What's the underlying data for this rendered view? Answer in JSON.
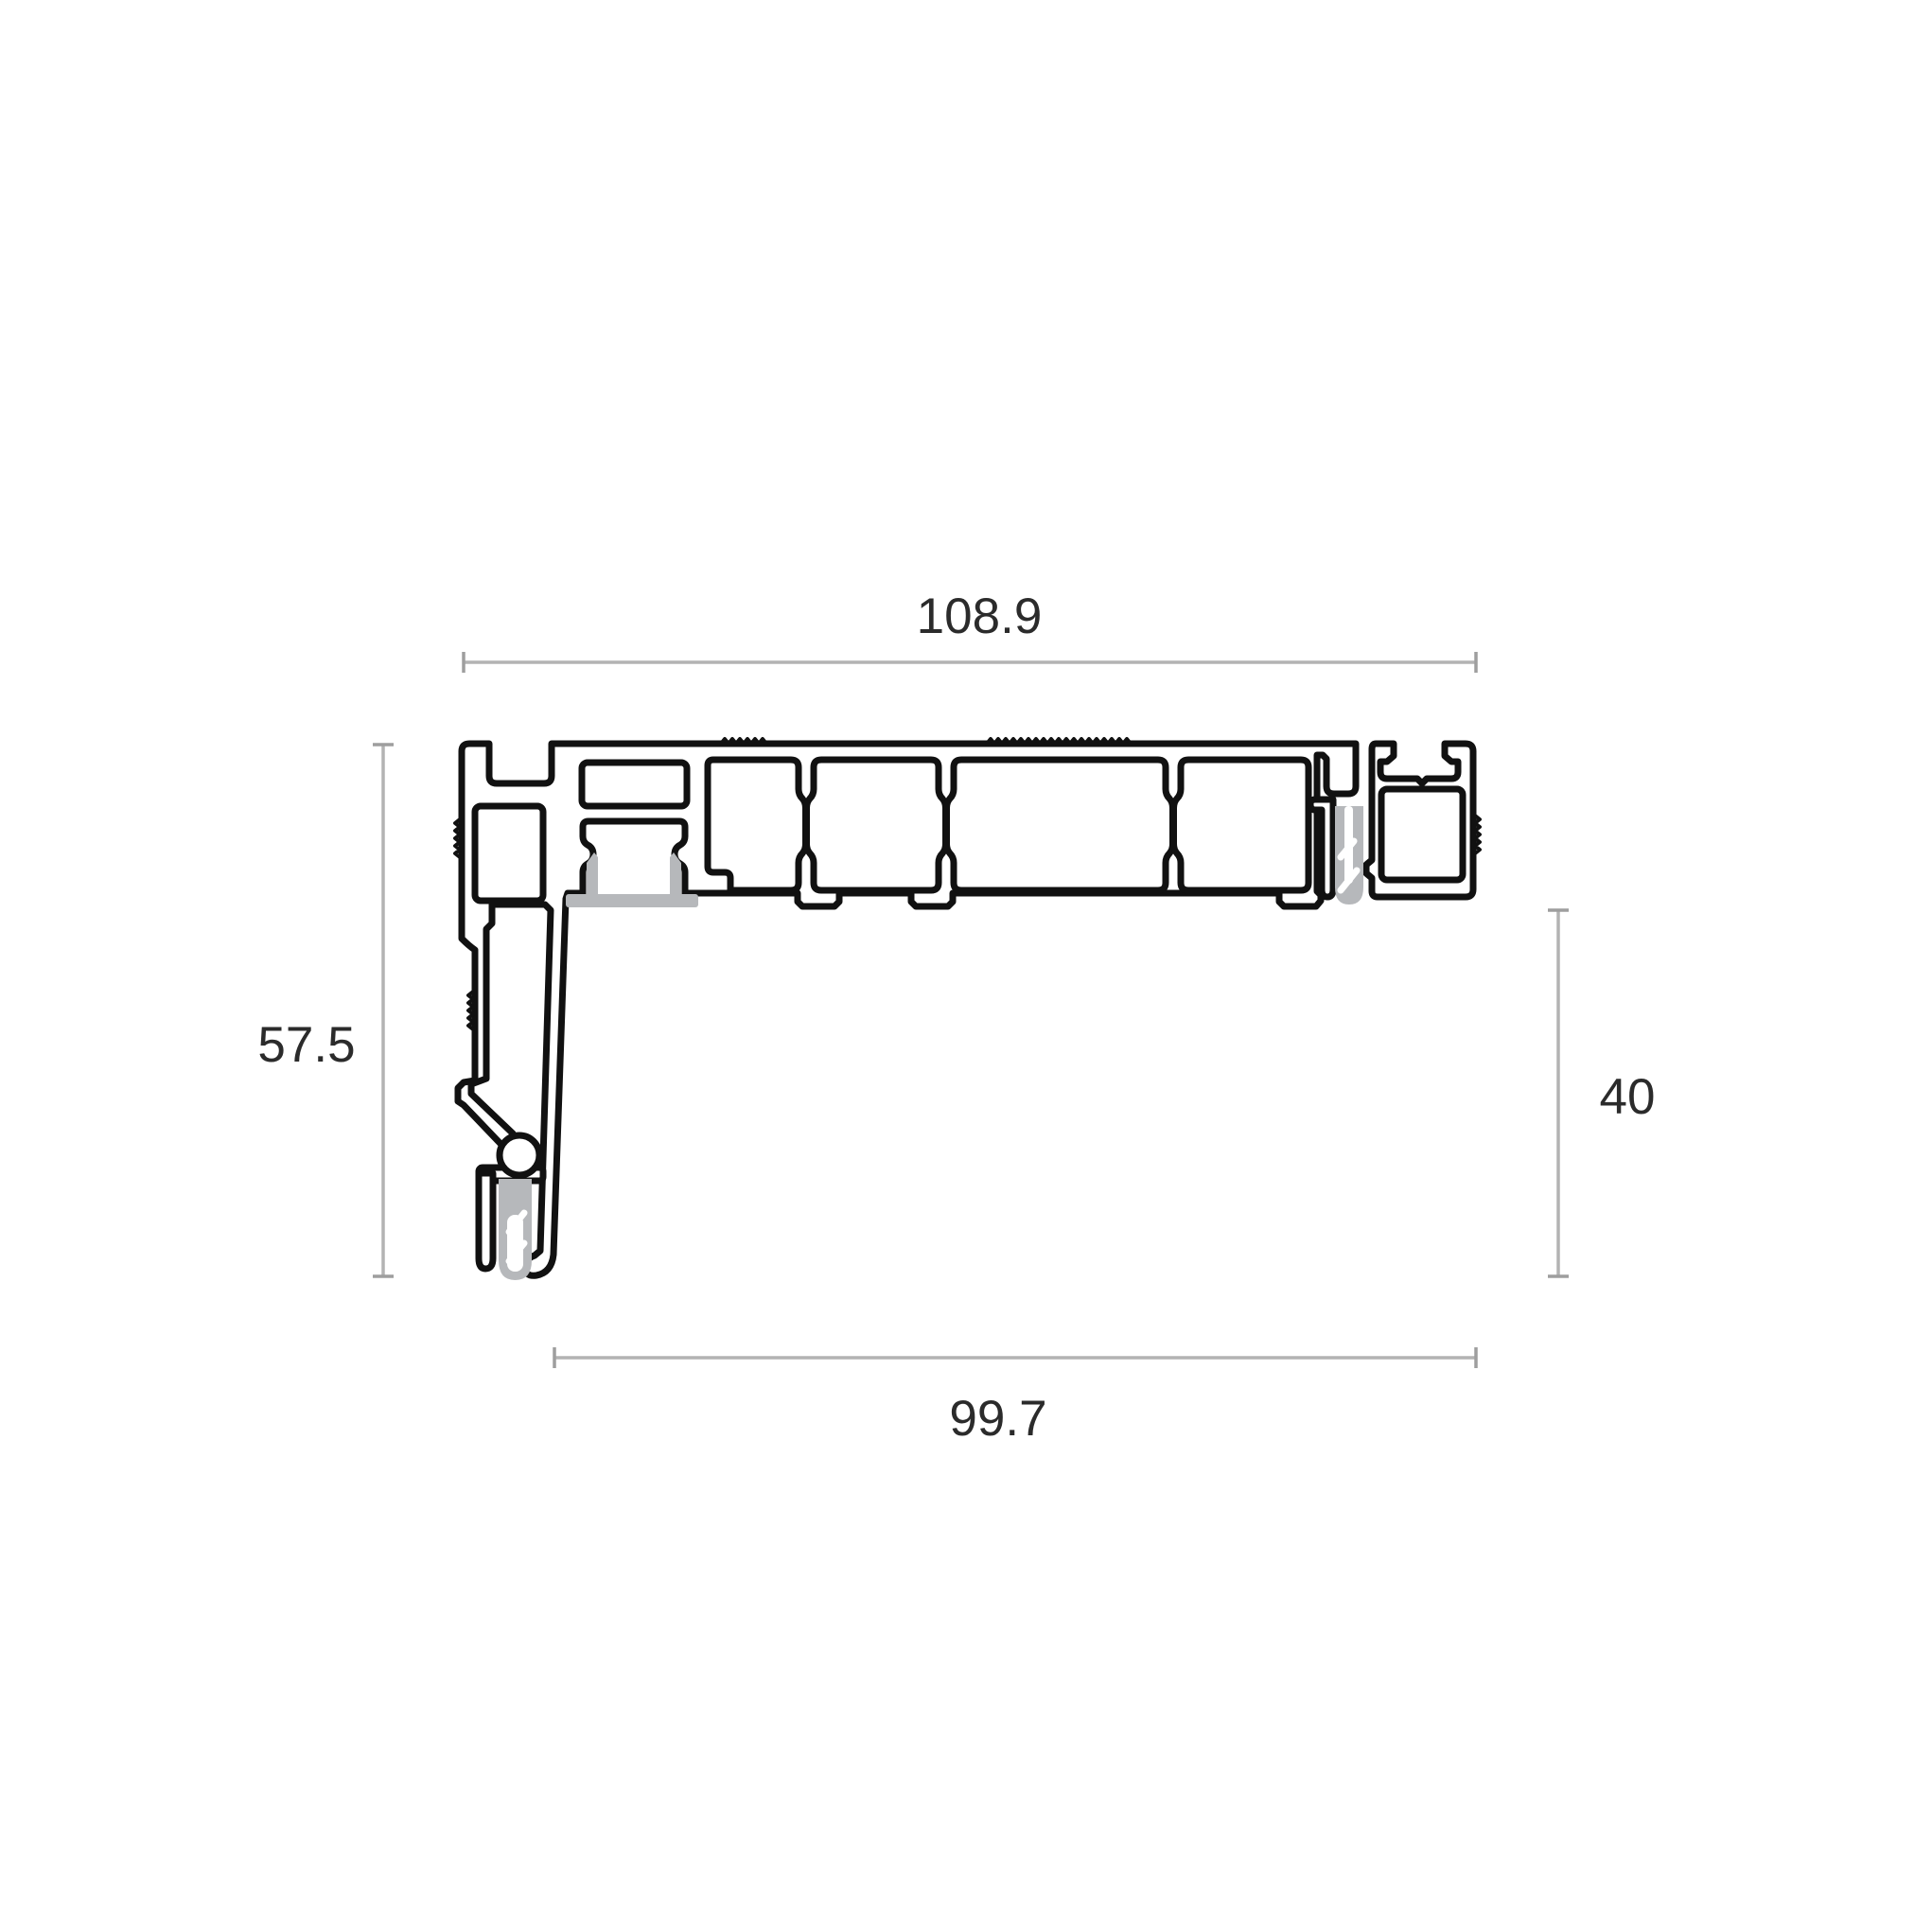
{
  "drawing": {
    "type": "technical-cross-section",
    "subject": "aluminium threshold profile cross-section with gasket and screw channels",
    "dimensions": {
      "top_width": "108.9",
      "left_height": "57.5",
      "right_height": "40",
      "bottom_width": "99.7"
    },
    "colors": {
      "outline": "#111111",
      "body_fill": "#ffffff",
      "accessory_gray": "#b6b8bb",
      "dimension_line": "#b3b3b3",
      "tick": "#9e9e9e",
      "label_text": "#2b2b2b",
      "background": "#ffffff"
    }
  }
}
